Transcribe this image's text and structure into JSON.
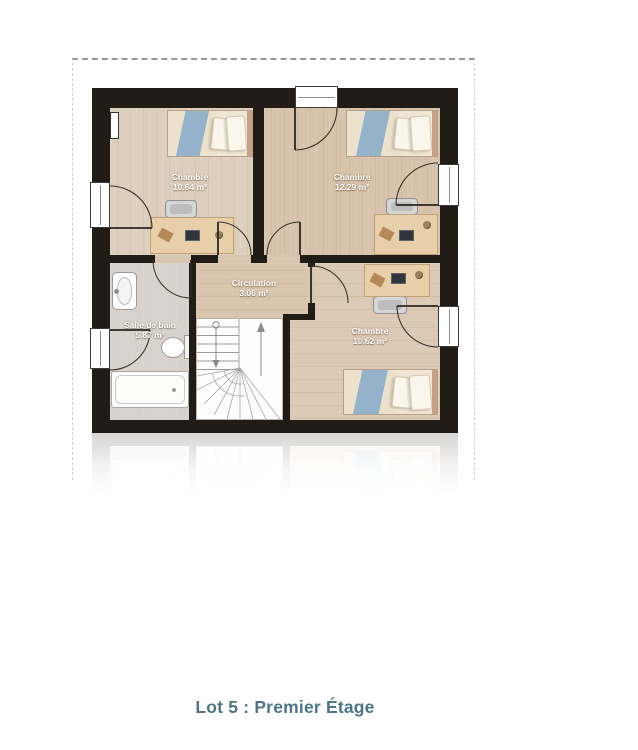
{
  "title": "Lot 5 : Premier Étage",
  "rooms": [
    {
      "name": "Chambre",
      "area": "10.64 m²"
    },
    {
      "name": "Chambre",
      "area": "12.29 m²"
    },
    {
      "name": "Salle de bain",
      "area": "5.87 m²"
    },
    {
      "name": "Circulation",
      "area": "3.06 m²"
    },
    {
      "name": "Chambre",
      "area": "10.62 m²"
    }
  ],
  "colors": {
    "wall": "#221c16",
    "wood_floor": "#d9c6b1",
    "bath_floor": "#d7d3cc",
    "bed_blanket": "#94b3cb",
    "title_text": "#4d7585"
  }
}
